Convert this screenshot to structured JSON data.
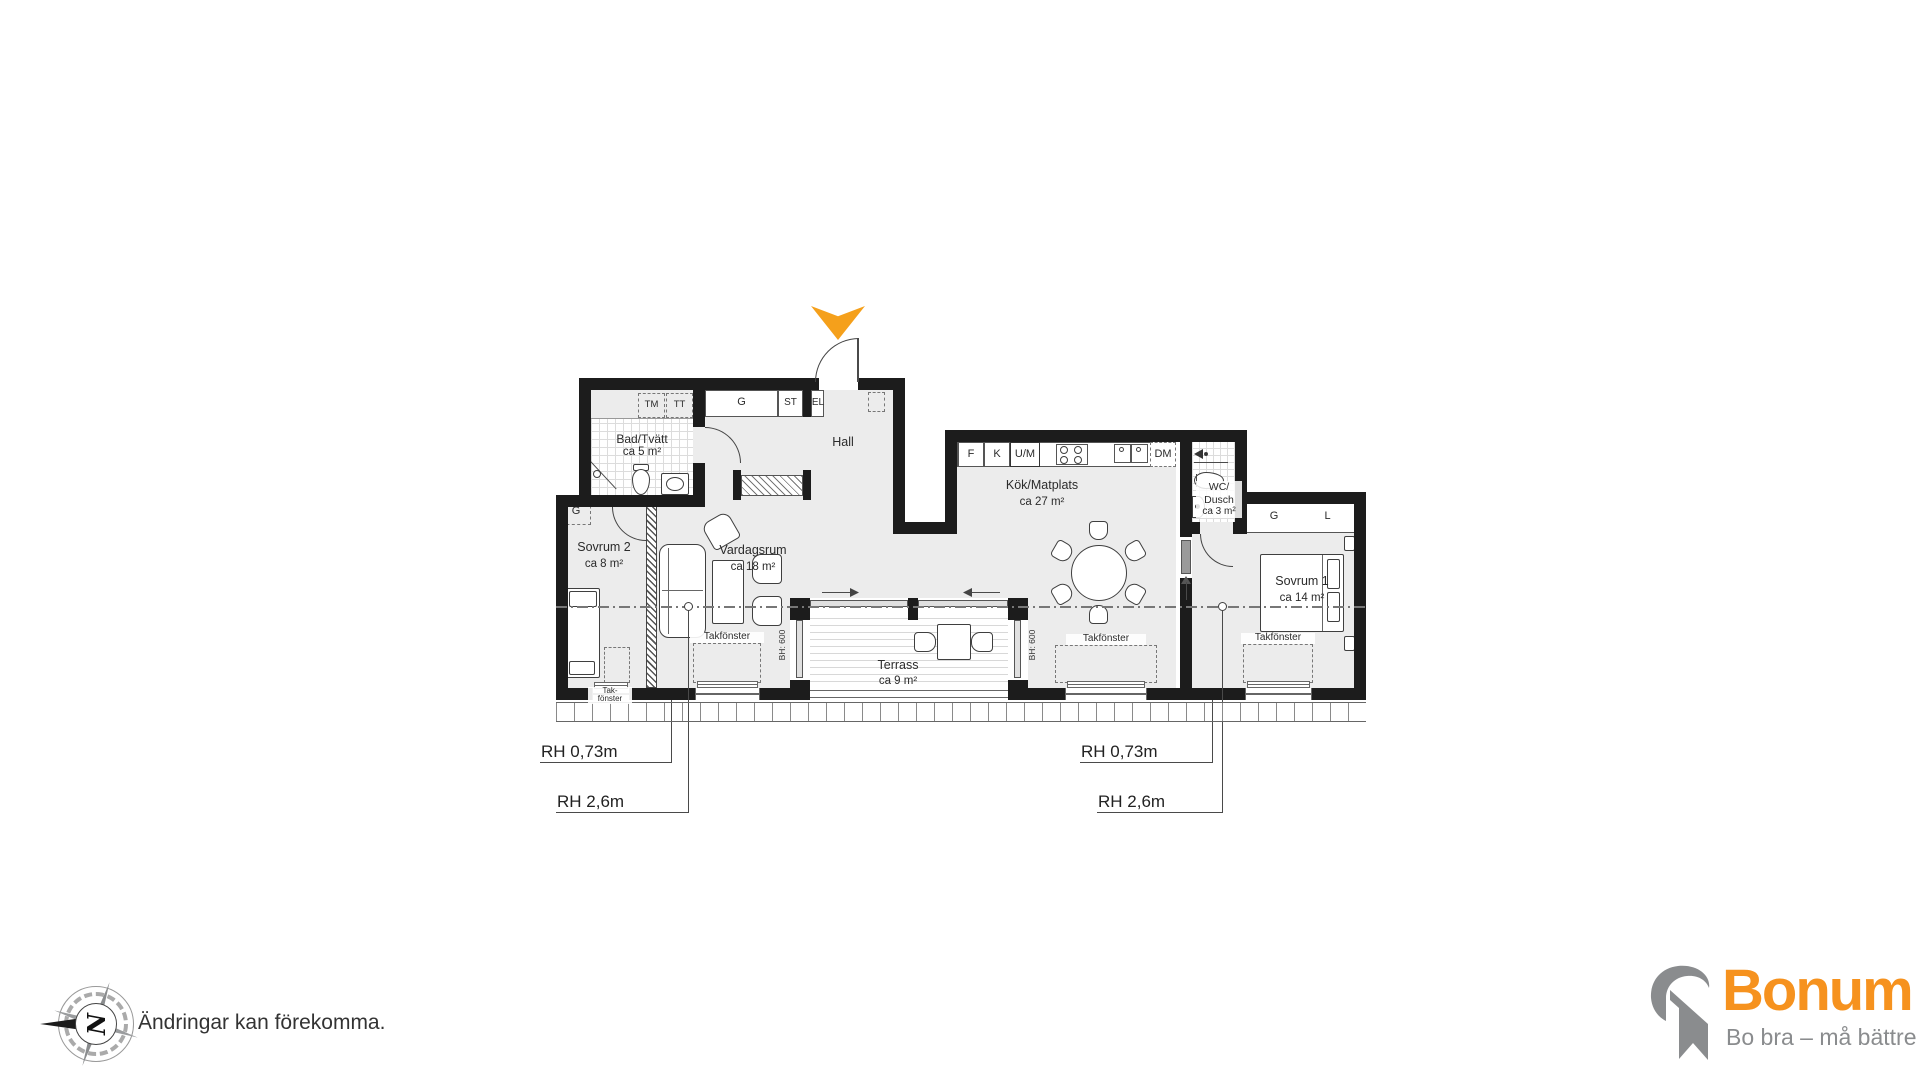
{
  "rooms": {
    "bad_tvatt": {
      "name": "Bad/Tvätt",
      "area": "ca 5 m²"
    },
    "hall": {
      "name": "Hall"
    },
    "sovrum2": {
      "name": "Sovrum 2",
      "area": "ca 8 m²"
    },
    "vardagsrum": {
      "name": "Vardagsrum",
      "area": "ca 18 m²"
    },
    "kok": {
      "name": "Kök/Matplats",
      "area": "ca 27 m²"
    },
    "wc_dusch": {
      "line1": "WC/",
      "line2": "Dusch",
      "area": "ca 3 m²"
    },
    "sovrum1": {
      "name": "Sovrum 1",
      "area": "ca 14 m²"
    },
    "terrass": {
      "name": "Terrass",
      "area": "ca 9 m²"
    }
  },
  "cabinets": {
    "tm": "TM",
    "tt": "TT",
    "g_hall": "G",
    "st": "ST",
    "el": "EL",
    "g_sovrum2": "G",
    "f": "F",
    "k": "K",
    "um": "U/M",
    "dm": "DM",
    "g_sovrum1": "G",
    "l_sovrum1": "L"
  },
  "annotations": {
    "takfonster": "Takfönster",
    "takfonster_small_line1": "Tak-",
    "takfonster_small_line2": "fönster",
    "window_height": "BH: 600",
    "rh_low": "RH 0,73m",
    "rh_high": "RH 2,6m"
  },
  "footer": {
    "disclaimer": "Ändringar kan förekomma.",
    "compass_letter": "N"
  },
  "brand": {
    "name": "Bonum",
    "tagline": "Bo bra – må bättre"
  },
  "colors": {
    "accent_orange": "#F5A01B",
    "brand_orange": "#F6921E",
    "brand_gray": "#8A8C8E"
  }
}
